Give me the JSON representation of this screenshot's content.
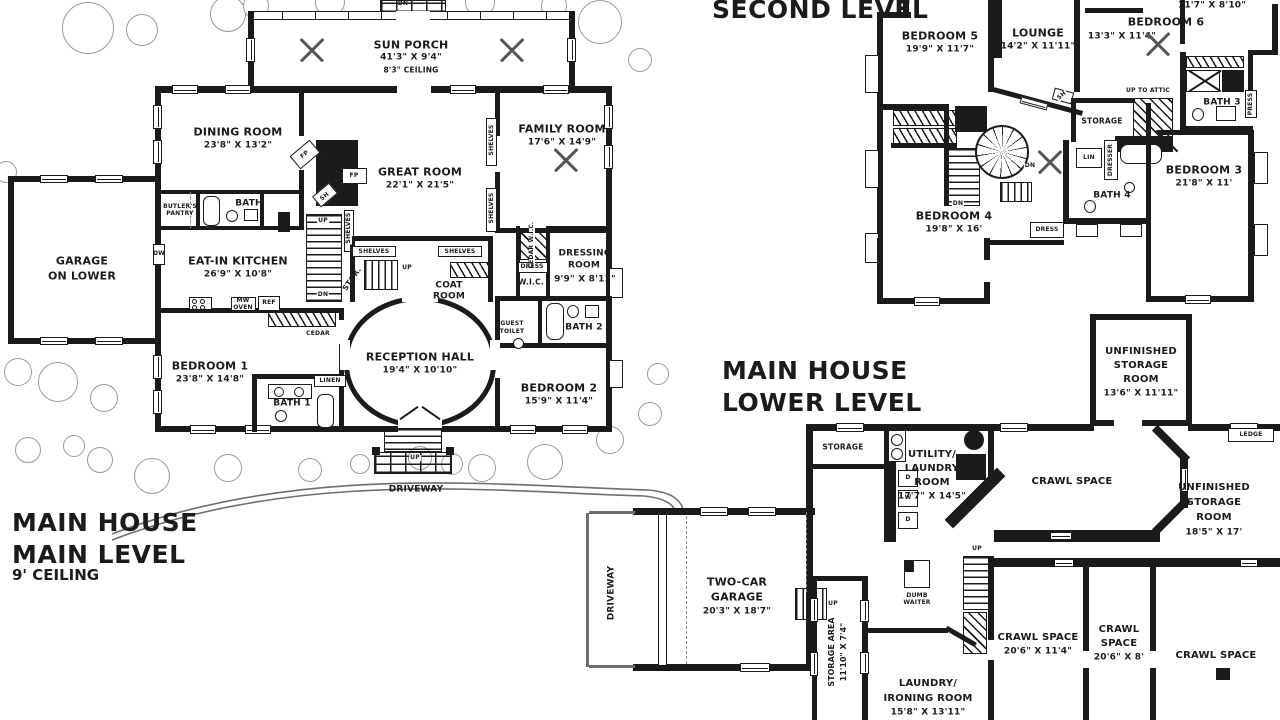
{
  "titles": {
    "second_level": "SECOND LEVEL",
    "main1": "MAIN HOUSE",
    "main2": "MAIN LEVEL",
    "main_ceiling": "9' CEILING",
    "lower1": "MAIN HOUSE",
    "lower2": "LOWER LEVEL"
  },
  "common": {
    "up": "UP",
    "dn": "DN",
    "dw": "DW",
    "ref": "REF",
    "mw": "MW",
    "oven": "OVEN",
    "d": "D",
    "w": "W",
    "fp": "FP",
    "sh": "SH",
    "shelves": "SHELVES"
  },
  "main_level": {
    "sun_porch": {
      "name": "SUN PORCH",
      "dims": "41'3\" X 9'4\"",
      "note": "8'3\" CEILING"
    },
    "dining_room": {
      "name": "DINING ROOM",
      "dims": "23'8\" X 13'2\""
    },
    "family_room": {
      "name": "FAMILY ROOM",
      "dims": "17'6\" X 14'9\""
    },
    "great_room": {
      "name": "GREAT ROOM",
      "dims": "22'1\" X 21'5\""
    },
    "garage_lower": {
      "line1": "GARAGE",
      "line2": "ON LOWER"
    },
    "butlers_pantry": {
      "line1": "BUTLER'S",
      "line2": "PANTRY"
    },
    "bath": "BATH",
    "eat_in_kitchen": {
      "name": "EAT-IN KITCHEN",
      "dims": "26'9\" X 10'8\""
    },
    "bedroom1": {
      "name": "BEDROOM 1",
      "dims": "23'8\" X 14'8\""
    },
    "bath1": "BATH 1",
    "linen": "LINEN",
    "cedar": "CEDAR",
    "stor": "STOR.",
    "reception_hall": {
      "name": "RECEPTION HALL",
      "dims": "19'4\" X 10'10\""
    },
    "coat_room": {
      "line1": "COAT",
      "line2": "ROOM"
    },
    "cedar_wic": "CEDAR W.I.C.",
    "dress": "DRESS",
    "wic": "W.I.C.",
    "dressing_room": {
      "line1": "DRESSING",
      "line2": "ROOM",
      "dims": "9'9\" X 8'11\""
    },
    "guest_toilet": {
      "line1": "GUEST",
      "line2": "TOILET"
    },
    "bath2": "BATH 2",
    "bedroom2": {
      "name": "BEDROOM 2",
      "dims": "15'9\" X 11'4\""
    },
    "driveway": "DRIVEWAY"
  },
  "second_level": {
    "partial_dims": "11'7\" X 8'10\"",
    "bedroom5": {
      "name": "BEDROOM 5",
      "dims": "19'9\" X 11'7\""
    },
    "lounge": {
      "name": "LOUNGE",
      "dims": "14'2\" X 11'11\""
    },
    "bedroom6": {
      "name": "BEDROOM 6",
      "dims": "13'3\" X 11'4\""
    },
    "bedroom4": {
      "name": "BEDROOM 4",
      "dims": "19'8\" X 16'"
    },
    "bedroom3": {
      "name": "BEDROOM 3",
      "dims": "21'8\" X 11'"
    },
    "bath3": "BATH 3",
    "bath4": "BATH 4",
    "storage": "STORAGE",
    "up_to_attic": "UP TO ATTIC",
    "lin": "LIN",
    "dresser": "DRESSER",
    "press": "PRESS",
    "dress": "DRESS"
  },
  "lower_level": {
    "storage": "STORAGE",
    "utility": {
      "line1": "UTILITY/",
      "line2": "LAUNDRY",
      "line3": "ROOM",
      "dims": "17'7\" X 14'5\""
    },
    "crawl_space": "CRAWL SPACE",
    "crawl1_dims": "20'6\" X 11'4\"",
    "crawl2": {
      "line1": "CRAWL",
      "line2": "SPACE",
      "dims": "20'6\" X 8'"
    },
    "unfin_top": {
      "line1": "UNFINISHED",
      "line2": "STORAGE",
      "line3": "ROOM",
      "dims": "13'6\" X 11'11\""
    },
    "unfin_right": {
      "line1": "UNFINISHED",
      "line2": "STORAGE",
      "line3": "ROOM",
      "dims": "18'5\" X 17'"
    },
    "ledge": "LEDGE",
    "garage": {
      "line1": "TWO-CAR",
      "line2": "GARAGE",
      "dims": "20'3\" X 18'7\""
    },
    "driveway": "DRIVEWAY",
    "storage_area": {
      "name": "STORAGE AREA",
      "dims": "11'10\" X 7'4\""
    },
    "dumb_waiter": {
      "line1": "DUMB",
      "line2": "WAITER"
    },
    "laundry": {
      "line1": "LAUNDRY/",
      "line2": "IRONING ROOM",
      "dims": "15'8\" X 13'11\""
    }
  }
}
